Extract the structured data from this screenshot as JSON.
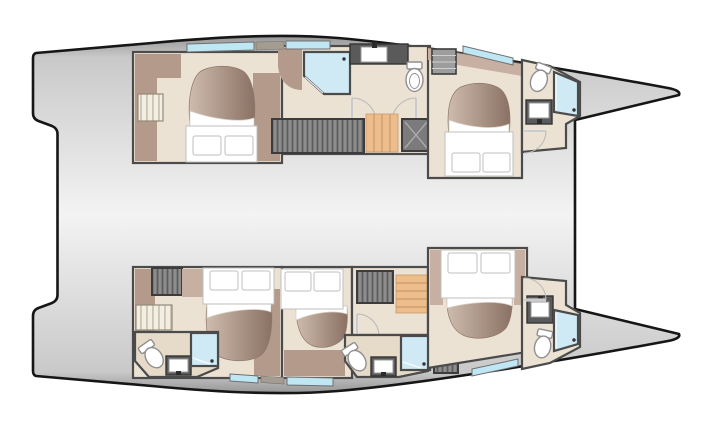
{
  "diagram": {
    "label": "Catamaran yacht interior deck plan, top view, bows pointing right",
    "type": "floor-plan",
    "hulls": [
      {
        "name": "upper-hull",
        "rooms": [
          "aft-cabin",
          "mid-corridor",
          "shower-room",
          "toilet-room",
          "forward-cabin",
          "bow-bathroom"
        ],
        "furniture": [
          "double-bed",
          "double-bed",
          "staircase",
          "louver-wardrobe",
          "washbasin",
          "washbasin",
          "toilet",
          "toilet",
          "shower",
          "shower",
          "shelf-unit",
          "technical-locker"
        ]
      },
      {
        "name": "lower-hull",
        "rooms": [
          "aft-cabin",
          "aft-bathroom",
          "mid-cabin",
          "mid-corridor",
          "mid-bathroom",
          "forward-cabin",
          "bow-bathroom"
        ],
        "furniture": [
          "double-bed",
          "double-bed",
          "double-bed",
          "staircase",
          "louver-locker",
          "louver-locker",
          "washbasin",
          "washbasin",
          "washbasin",
          "toilet",
          "toilet",
          "toilet",
          "shower",
          "shower",
          "shower"
        ]
      }
    ],
    "windows": [
      "hull-window",
      "hull-window",
      "hull-window",
      "hull-window",
      "hull-window",
      "hull-window"
    ]
  },
  "colors": {
    "background": "#ffffff",
    "outline": "#161616",
    "deck_edge": "#969696",
    "deck_soft": "#c9c9c9",
    "deck_center": "#f3f3f3",
    "wall": "#4b4b4b",
    "floor": "#ece2d3",
    "floor_shade": "#e6dac8",
    "furniture_brown": "#b49a8b",
    "furniture_brown_light": "#c7b0a1",
    "spread_dark": "#8a7163",
    "spread_light": "#cfbcae",
    "mattress": "#ffffff",
    "mattress_line": "#bfbfbf",
    "window_glass": "#bfe7f3",
    "window_frame": "#6f6f6f",
    "window_mullion": "#a49b91",
    "shower_glass": "#cfeaf5",
    "stairs_wood": "#edbd8c",
    "stairs_line": "#c9996a",
    "louver_dark": "#8d8d8d",
    "louver_stripe": "#5c5c5c",
    "locker_light": "#f3eee3",
    "locker_stripe": "#c6bba6",
    "fixture_dark": "#5a5a5a",
    "porcelain": "#ffffff",
    "porcelain_line": "#8f8f8f",
    "door_arc": "#b9b9b9",
    "shelf_gray": "#9d9d9d",
    "tech_gray": "#7b7b7b"
  }
}
